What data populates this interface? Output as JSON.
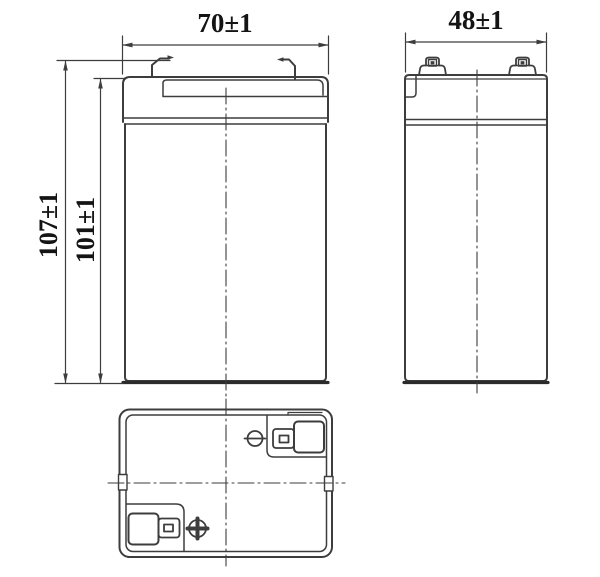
{
  "drawing": {
    "type": "engineering-drawing",
    "subject": "battery outline dimensions, three orthographic views",
    "dimensions": {
      "front_width": "70±1",
      "side_width": "48±1",
      "overall_height": "107±1",
      "case_height": "101±1"
    },
    "icons": {
      "negative_terminal": "circle-minus",
      "positive_terminal": "circle-plus"
    },
    "colors": {
      "line": "#3d3d3d",
      "heavy_line": "#2b2b2b",
      "text": "#141414",
      "background": "#ffffff"
    }
  }
}
